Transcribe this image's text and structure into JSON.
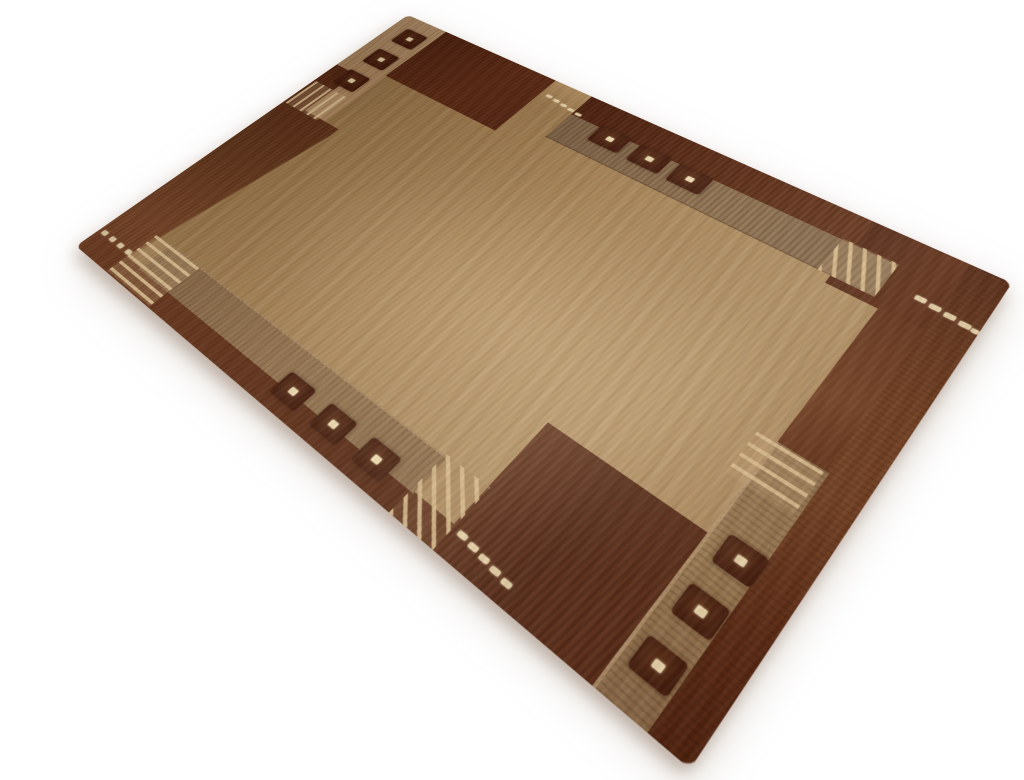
{
  "scene": {
    "type": "product-photograph",
    "subject": "Modern hand-knotted wool area rug shown at a three-quarter perspective angle on a plain white studio background",
    "background_color": "#ffffff"
  },
  "rug": {
    "design": "Two-tone geometric Nepali/Gabbeh style: camel field, chocolate-brown asymmetric border bands and corner blocks, taupe mottled inner bands, dark squares with cream center knots, cream accent dots and thin comb-stripe groups",
    "colors": {
      "field": "#9c7b51",
      "field_light": "#b08c60",
      "field_dark": "#8a6b44",
      "border_dark": "#53230f",
      "border_dark_deep": "#471c0b",
      "border_sheen": "#7b4628",
      "band_mottled": "#84684a",
      "band_mottled_light": "#93744f",
      "band_tan": "#b28d64",
      "stripe_light": "#d8ba8e",
      "square_dark": "#3d1507",
      "accent_cream": "#ecd9ae"
    },
    "motifs": {
      "square_groups": 4,
      "squares_per_group": 3,
      "dot_groups": 4,
      "stripe_groups": 5
    },
    "squares": [
      {
        "x": 24,
        "y": 26,
        "w": 40,
        "h": 36
      },
      {
        "x": 24,
        "y": 85,
        "w": 40,
        "h": 36
      },
      {
        "x": 24,
        "y": 144,
        "w": 40,
        "h": 36
      },
      {
        "x": 374,
        "y": 38,
        "w": 44,
        "h": 34
      },
      {
        "x": 432,
        "y": 40,
        "w": 44,
        "h": 34
      },
      {
        "x": 488,
        "y": 42,
        "w": 44,
        "h": 34
      },
      {
        "x": 769,
        "y": 412,
        "w": 36,
        "h": 32
      },
      {
        "x": 767,
        "y": 470,
        "w": 36,
        "h": 32
      },
      {
        "x": 765,
        "y": 528,
        "w": 36,
        "h": 32
      },
      {
        "x": 346,
        "y": 543,
        "w": 38,
        "h": 32
      },
      {
        "x": 406,
        "y": 543,
        "w": 38,
        "h": 32
      },
      {
        "x": 466,
        "y": 543,
        "w": 38,
        "h": 32
      }
    ],
    "dots": [
      {
        "x": 6,
        "y": 551,
        "w": 9,
        "h": 7
      },
      {
        "x": 23,
        "y": 551,
        "w": 9,
        "h": 7
      },
      {
        "x": 40,
        "y": 551,
        "w": 9,
        "h": 7
      },
      {
        "x": 57,
        "y": 551,
        "w": 9,
        "h": 7
      },
      {
        "x": 776,
        "y": 70,
        "w": 11,
        "h": 7
      },
      {
        "x": 791,
        "y": 72,
        "w": 11,
        "h": 7
      },
      {
        "x": 806,
        "y": 74,
        "w": 11,
        "h": 7
      },
      {
        "x": 821,
        "y": 76,
        "w": 11,
        "h": 7
      },
      {
        "x": 833,
        "y": 78,
        "w": 7,
        "h": 6
      },
      {
        "x": 281,
        "y": 29,
        "w": 9,
        "h": 5
      },
      {
        "x": 294,
        "y": 31,
        "w": 9,
        "h": 5
      },
      {
        "x": 307,
        "y": 33,
        "w": 9,
        "h": 5
      },
      {
        "x": 320,
        "y": 35,
        "w": 9,
        "h": 5
      },
      {
        "x": 333,
        "y": 37,
        "w": 9,
        "h": 5
      },
      {
        "x": 592,
        "y": 560,
        "w": 10,
        "h": 6
      },
      {
        "x": 606,
        "y": 562,
        "w": 10,
        "h": 6
      },
      {
        "x": 620,
        "y": 564,
        "w": 10,
        "h": 6
      },
      {
        "x": 634,
        "y": 566,
        "w": 10,
        "h": 6
      },
      {
        "x": 648,
        "y": 568,
        "w": 10,
        "h": 6
      }
    ]
  }
}
